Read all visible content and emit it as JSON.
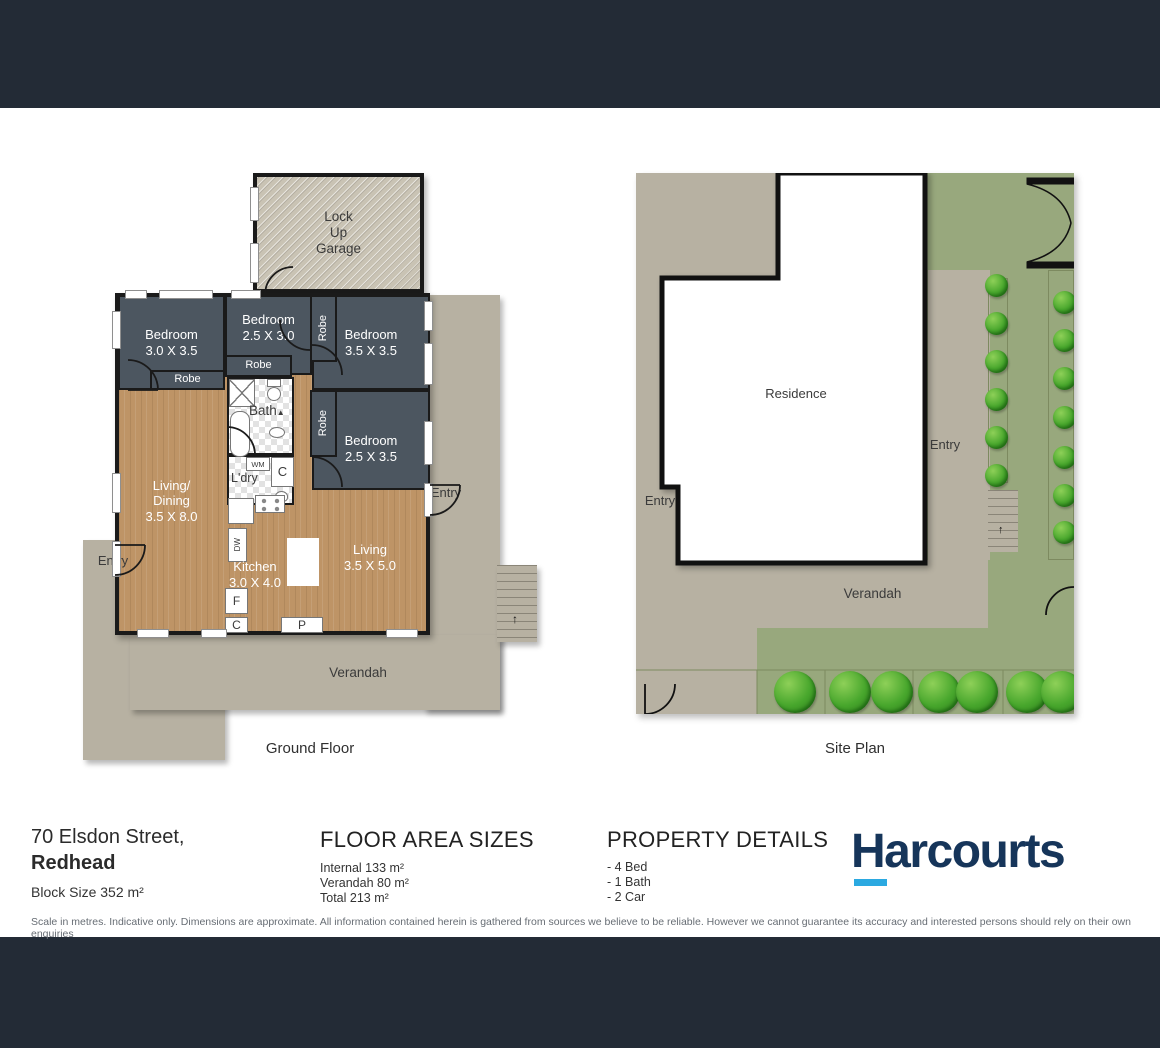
{
  "ground_floor": {
    "caption": "Ground Floor",
    "garage": {
      "line1": "Lock",
      "line2": "Up",
      "line3": "Garage"
    },
    "bedroom1": {
      "name": "Bedroom",
      "dims": "3.0 X 3.5"
    },
    "bedroom2": {
      "name": "Bedroom",
      "dims": "2.5 X 3.0"
    },
    "bedroom3": {
      "name": "Bedroom",
      "dims": "3.5 X 3.5"
    },
    "bedroom4": {
      "name": "Bedroom",
      "dims": "2.5 X 3.5"
    },
    "living_dining": {
      "line1": "Living/",
      "line2": "Dining",
      "dims": "3.5 X 8.0"
    },
    "kitchen": {
      "name": "Kitchen",
      "dims": "3.0 X 4.0"
    },
    "living": {
      "name": "Living",
      "dims": "3.5 X 5.0"
    },
    "labels": {
      "robe": "Robe",
      "bath": "Bath",
      "ldry": "L'dry",
      "wm": "WM",
      "dw": "DW",
      "f": "F",
      "c": "C",
      "p": "P",
      "entry": "Entry",
      "verandah": "Verandah"
    }
  },
  "site_plan": {
    "caption": "Site Plan",
    "residence": "Residence",
    "entry": "Entry",
    "verandah": "Verandah"
  },
  "footer": {
    "address_line1": "70 Elsdon Street,",
    "address_line2": "Redhead",
    "block_size": "Block Size 352 m²",
    "floor_area": {
      "title": "FLOOR AREA SIZES",
      "items": [
        "Internal 133 m²",
        "Verandah 80 m²",
        "Total 213 m²"
      ]
    },
    "property_details": {
      "title": "PROPERTY DETAILS",
      "items": [
        "- 4 Bed",
        "- 1 Bath",
        "- 2 Car"
      ]
    },
    "brand": "Harcourts",
    "disclaimer": "Scale in metres. Indicative only. Dimensions are approximate. All information contained herein is gathered from sources we believe to be reliable. However we cannot guarantee its accuracy and interested persons should rely on their own enquiries"
  }
}
